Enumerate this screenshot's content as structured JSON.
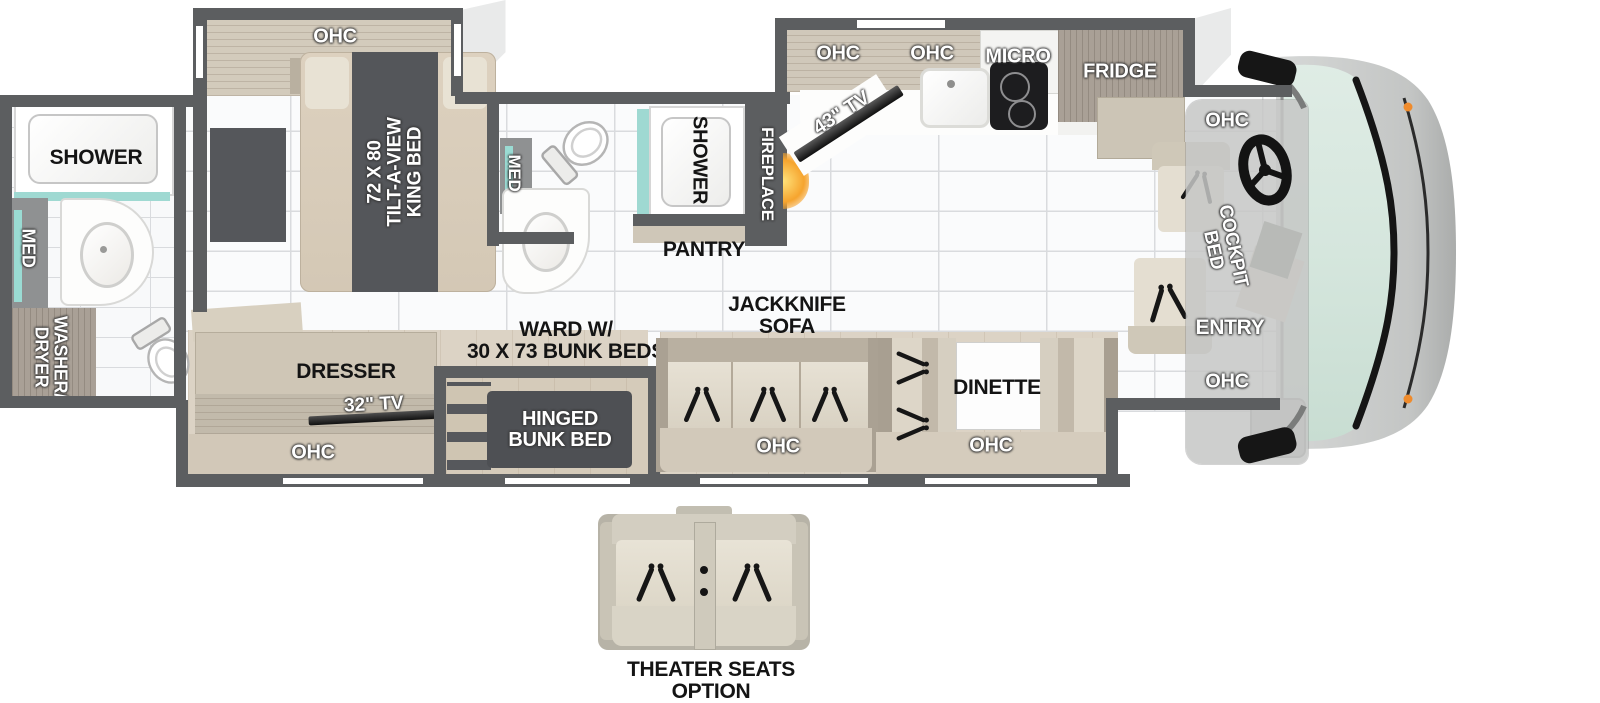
{
  "title": "Class A Motorhome Floorplan",
  "colors": {
    "wall": "#5c5e60",
    "glass_aqua": "#9fd9d2",
    "windshield": "#d8e8e0",
    "fire_glow": "#f6a42e",
    "marker_light": "#ef8b2c",
    "label_dark": "#141414",
    "label_light": "#ffffff",
    "wood": "#b3a89b",
    "floor_tile": "#fafbfc",
    "slide_floor": "#dcd3c5",
    "dark_panel": "#4e5054"
  },
  "rear_bath": {
    "shower": "SHOWER",
    "med": "MED",
    "washer": "WASHER/",
    "dryer": "DRYER"
  },
  "bedroom": {
    "ohc": "OHC",
    "bed_l1": "72 X 80",
    "bed_l2": "TILT-A-VIEW",
    "bed_l3": "KING BED"
  },
  "mid_bath": {
    "med": "MED",
    "shower": "SHOWER"
  },
  "hall": {
    "pantry": "PANTRY",
    "fireplace": "FIREPLACE"
  },
  "kitchen": {
    "tv": "43\" TV",
    "ohc1": "OHC",
    "ohc2": "OHC",
    "micro": "MICRO",
    "fridge": "FRIDGE"
  },
  "front": {
    "ohc_top": "OHC",
    "cockpit_l1": "COCKPIT",
    "cockpit_l2": "BED",
    "entry": "ENTRY",
    "ohc_bottom": "OHC"
  },
  "living": {
    "jackknife_l1": "JACKKNIFE",
    "jackknife_l2": "SOFA",
    "sofa_ohc": "OHC",
    "dinette": "DINETTE",
    "dinette_ohc": "OHC"
  },
  "bunk": {
    "ward_l1": "WARD W/",
    "ward_l2": "30 X 73 BUNK BEDS",
    "dresser": "DRESSER",
    "tv": "32\" TV",
    "ohc": "OHC",
    "hinged_l1": "HINGED",
    "hinged_l2": "BUNK BED"
  },
  "option": {
    "l1": "THEATER SEATS",
    "l2": "OPTION"
  }
}
